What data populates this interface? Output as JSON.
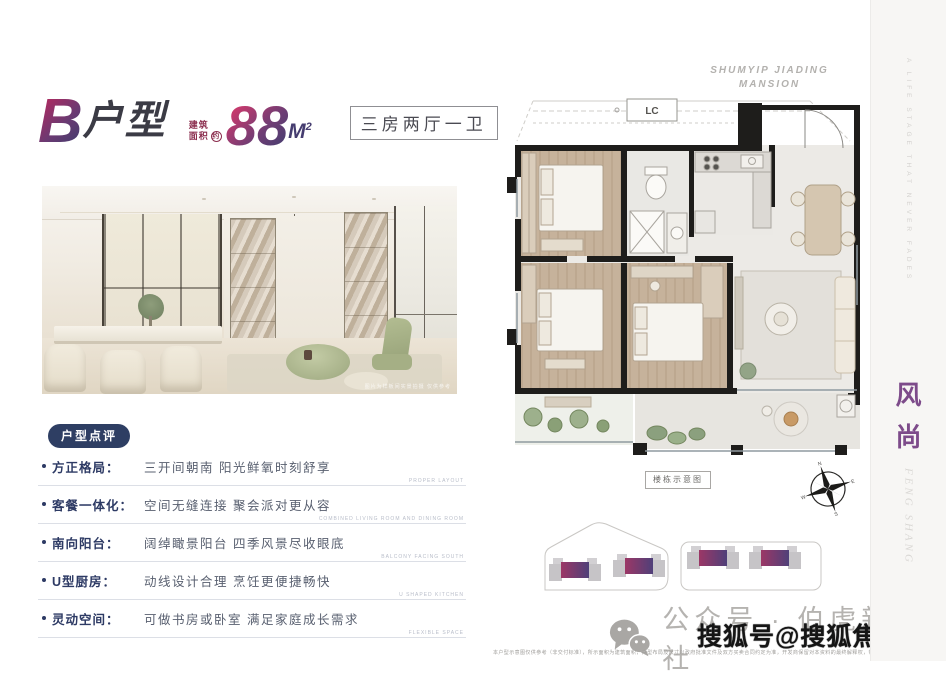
{
  "header": {
    "unit_letter": "B",
    "unit_word": "户型",
    "area_prefix_line1": "建筑",
    "area_prefix_line2": "面积",
    "area_approx": "约",
    "area_value": "88",
    "area_unit": "M",
    "area_sup": "2",
    "rooms_label": "三房两厅一卫"
  },
  "brand": {
    "project_en_line1": "SHUMYIP JIADING",
    "project_en_line2": "MANSION",
    "sidebar_vertical_en": "A LIFE STAGE THAT NEVER FADES",
    "sidebar_cn_1": "风",
    "sidebar_cn_2": "尚",
    "sidebar_en_italic": "FENG SHANG"
  },
  "review": {
    "badge": "户型点评",
    "items": [
      {
        "label": "方正格局：",
        "text": "三开间朝南 阳光鲜氧时刻舒享",
        "en": "PROPER LAYOUT"
      },
      {
        "label": "客餐一体化：",
        "text": "空间无缝连接 聚会派对更从容",
        "en": "COMBINED LIVING ROOM AND DINING ROOM"
      },
      {
        "label": "南向阳台：",
        "text": "阔绰瞰景阳台 四季风景尽收眼底",
        "en": "BALCONY FACING SOUTH"
      },
      {
        "label": "U型厨房：",
        "text": "动线设计合理 烹饪更便捷畅快",
        "en": "U SHAPED KITCHEN"
      },
      {
        "label": "灵动空间：",
        "text": "可做书房或卧室 满足家庭成长需求",
        "en": "FLEXIBLE SPACE"
      }
    ]
  },
  "floorplan": {
    "ac_label": "LC",
    "diagram_label": "楼栋示意图",
    "compass": {
      "n": "N",
      "e": "E",
      "s": "S",
      "w": "W"
    }
  },
  "photo": {
    "caption": "图片为样板间实景拍摄 仅供参考"
  },
  "watermarks": {
    "wechat": "公众号 · 伯虎新房社",
    "sohu": "搜狐号@搜狐焦点淮南站",
    "side_vertical": "搜狐焦点",
    "disclaimer": "本户型示意图仅供参考（非交付标准），所示面积为建筑面积，户型布局及尺寸以政府批准文件及双方买卖合同约定为准，开发商保留对本资料的最终解释权，敬请留意。"
  },
  "colors": {
    "accent_gradient_start": "#b02a60",
    "accent_gradient_end": "#433c6e",
    "badge_navy": "#2e3e63",
    "sidebar_purple": "#7d4b8a",
    "wall_black": "#1e1d1b",
    "wood_floor": "#c6b29b"
  }
}
